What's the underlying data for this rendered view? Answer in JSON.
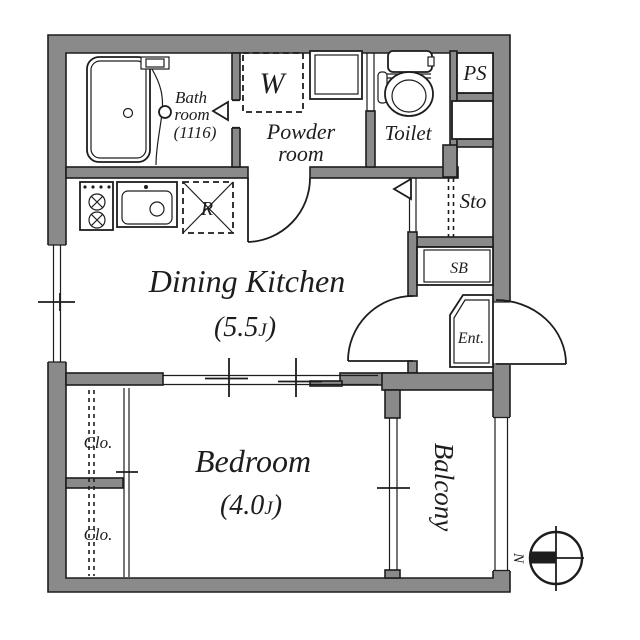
{
  "title": "Apartment floor plan",
  "colors": {
    "wall_fill": "#8a8a8a",
    "line": "#1d1d1d",
    "background": "#ffffff"
  },
  "compass": {
    "north_label": "N"
  },
  "rooms": {
    "bathroom": {
      "line1": "Bath",
      "line2": "room",
      "line3": "(1116)"
    },
    "powder_room": {
      "line1": "Powder",
      "line2": "room"
    },
    "washing_machine": {
      "symbol": "W"
    },
    "toilet": {
      "label": "Toilet"
    },
    "pipe_space": {
      "label": "PS"
    },
    "storage": {
      "label": "Sto"
    },
    "shoe_box": {
      "label": "SB"
    },
    "entrance": {
      "label": "Ent."
    },
    "refrigerator": {
      "symbol": "R"
    },
    "dining_kitchen": {
      "name": "Dining Kitchen",
      "size_value": "(5.5",
      "size_unit": "J",
      "size_close": ")"
    },
    "bedroom": {
      "name": "Bedroom",
      "size_value": "(4.0",
      "size_unit": "J",
      "size_close": ")"
    },
    "closet_upper": {
      "label": "Clo."
    },
    "closet_lower": {
      "label": "Clo."
    },
    "balcony": {
      "label": "Balcony"
    }
  }
}
